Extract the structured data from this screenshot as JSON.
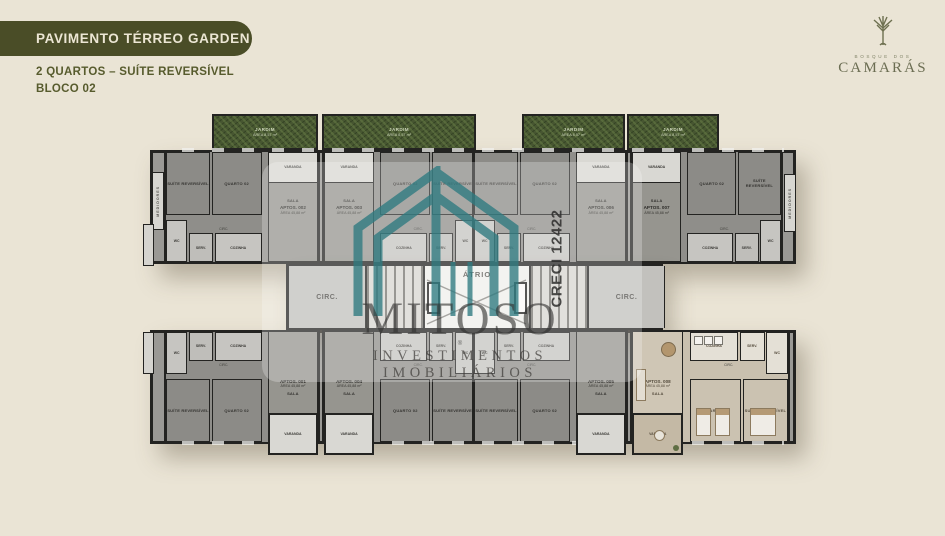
{
  "header": {
    "banner": "PAVIMENTO TÉRREO GARDEN",
    "subtitle_line1": "2 QUARTOS – SUÍTE REVERSÍVEL",
    "subtitle_line2": "BLOCO 02"
  },
  "brand": {
    "top": "BOSQUE DOS",
    "name": "CAMARÁS"
  },
  "watermark": {
    "name": "MITOSO",
    "reg": "®",
    "tagline": "INVESTIMENTOS IMOBILIÁRIOS",
    "creci": "CRECI 12422"
  },
  "colors": {
    "banner_olive": "#4a4d27",
    "text_olive": "#575b2d",
    "jardim_green": "#475631",
    "watermark_teal": "#2e7a80",
    "background_beige": "#eae4d5"
  },
  "plan": {
    "jardim": {
      "label": "JARDIM",
      "area": "ÁREA 8,57 m²"
    },
    "rooms": {
      "suite": "SUÍTE REVERSÍVEL",
      "quarto": "QUARTO 02",
      "sala": "SALA",
      "varanda": "VARANDA",
      "cozinha": "COZINHA",
      "serv": "SERV.",
      "wc": "WC",
      "circ": "CIRC.",
      "atrio": "ÁTRIO",
      "medidores": "MEDIDORES"
    },
    "units": [
      {
        "id": "APTOS. 001",
        "area": "ÁREA 45,88 m²"
      },
      {
        "id": "APTOS. 002",
        "area": "ÁREA 45,88 m²"
      },
      {
        "id": "APTOS. 003",
        "area": "ÁREA 45,88 m²"
      },
      {
        "id": "APTOS. 004",
        "area": "ÁREA 45,88 m²"
      },
      {
        "id": "APTOS. 005",
        "area": "ÁREA 45,88 m²"
      },
      {
        "id": "APTOS. 006",
        "area": "ÁREA 45,88 m²"
      },
      {
        "id": "APTOS. 007",
        "area": "ÁREA 45,88 m²"
      },
      {
        "id": "APTOS. 008",
        "area": "ÁREA 45,88 m²"
      }
    ]
  }
}
